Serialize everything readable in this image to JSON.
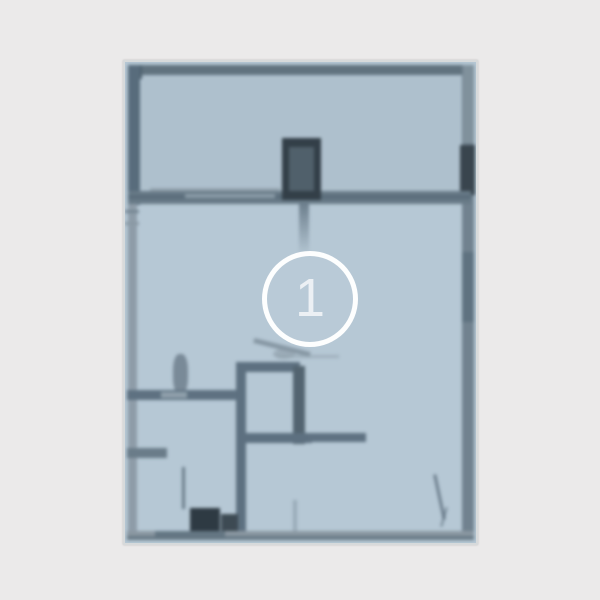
{
  "window": {
    "background_color": "#ebeaea"
  },
  "floorplan": {
    "kind": "blurred architectural floor plan photo",
    "fill_color": "#b6c8d5",
    "terrace_fill_color": "#aec0cd",
    "wall_color": "#5d7080",
    "dark_feature_color": "#2e3a43",
    "frame_color": "#d7dadb"
  },
  "marker": {
    "label": "1",
    "ring_color": "#ffffff"
  }
}
